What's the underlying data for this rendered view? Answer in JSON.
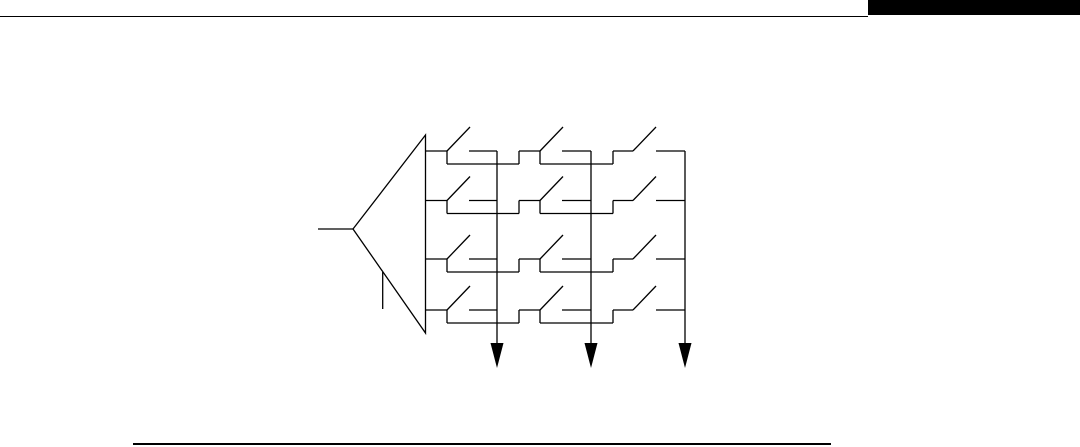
{
  "page": {
    "width": 1080,
    "height": 447,
    "background_color": "#ffffff",
    "ink_color": "#000000"
  },
  "header": {
    "rule": {
      "x1": 0,
      "x2": 868,
      "y": 15.5,
      "thickness": 1.8
    },
    "chapter_tab": {
      "x": 868,
      "y": 0,
      "width": 212,
      "height": 15,
      "color": "#000000"
    }
  },
  "footer": {
    "rule": {
      "x1": 133,
      "x2": 831,
      "y": 443,
      "thickness": 2
    }
  },
  "diagram": {
    "type": "crossbar-switch-matrix-schematic",
    "description": "Amplifier driving a 4-row by 3-column matrix of open switches with three output column lines ending in filled downward arrows",
    "stroke_width": 1.3,
    "amplifier": {
      "tip_x": 353,
      "tip_y": 229,
      "base_x": 425.5,
      "base_top_y": 135,
      "base_bottom_y": 333,
      "input_lead_x1": 318,
      "lower_lead": {
        "x": 382.7,
        "y1": 272,
        "y2": 309
      }
    },
    "matrix": {
      "row_count": 4,
      "column_count": 3,
      "row_ys": [
        151,
        200.5,
        259,
        310
      ],
      "pole_xs": [
        447,
        540,
        633
      ],
      "contact_start_xs": [
        469,
        562,
        656
      ],
      "column_xs": [
        497,
        591,
        685
      ],
      "stepup_xs": [
        519,
        613
      ],
      "bypass_dy": 13,
      "blade_dx": 23,
      "blade_dy": -24
    },
    "output_arrows": {
      "count": 3,
      "shaft_top_y": 151,
      "shaft_end_y": 345,
      "head_top_y": 343,
      "tip_y": 368,
      "half_width": 6.5,
      "fill": "#000000"
    }
  }
}
